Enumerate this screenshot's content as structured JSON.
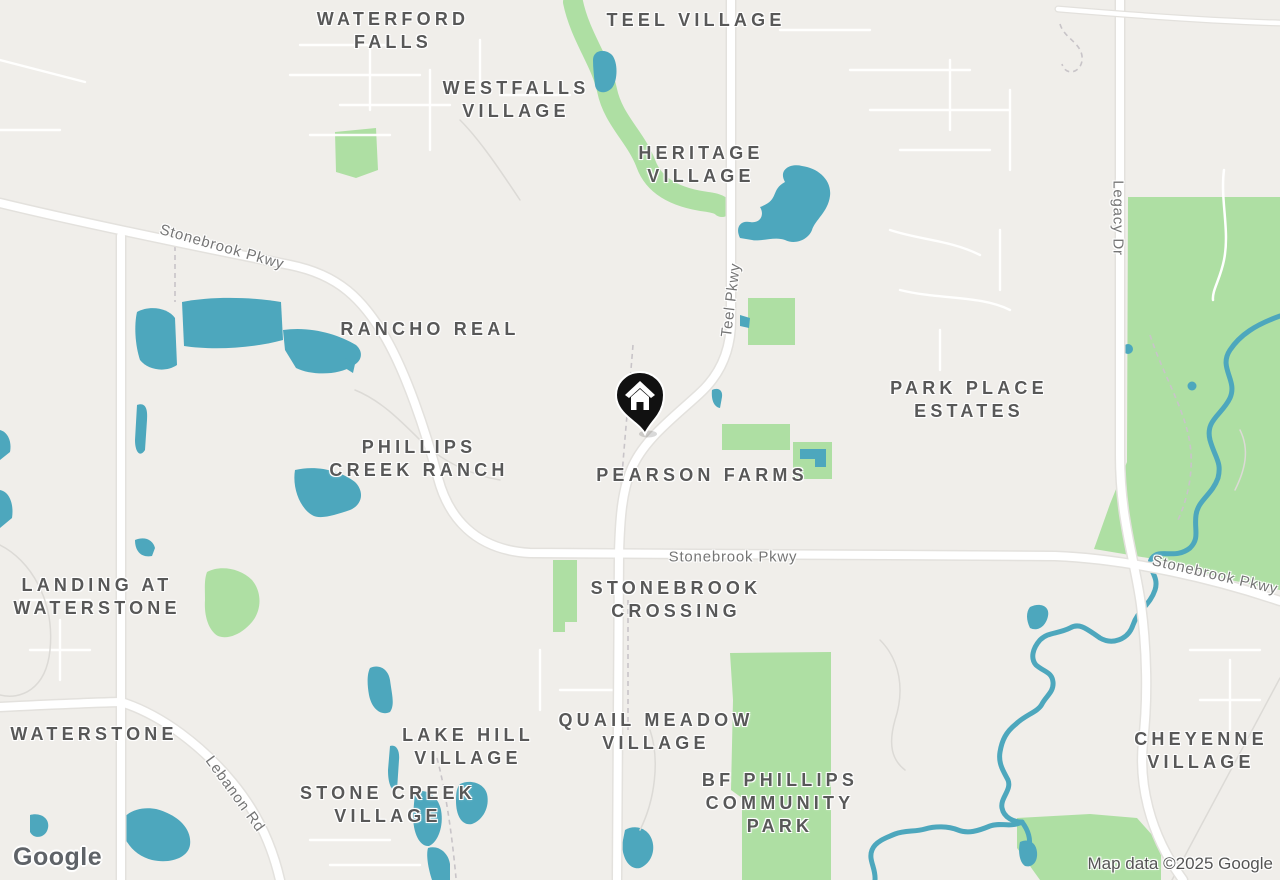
{
  "map": {
    "attribution": "Map data ©2025 Google",
    "logo": "Google",
    "marker": {
      "type": "home",
      "x": 640,
      "y": 400
    },
    "neighborhood_labels": [
      {
        "lines": [
          "WATERFORD",
          "FALLS"
        ],
        "x": 393,
        "y": 8
      },
      {
        "lines": [
          "TEEL VILLAGE"
        ],
        "x": 696,
        "y": 9
      },
      {
        "lines": [
          "WESTFALLS",
          "VILLAGE"
        ],
        "x": 516,
        "y": 77
      },
      {
        "lines": [
          "HERITAGE",
          "VILLAGE"
        ],
        "x": 701,
        "y": 142
      },
      {
        "lines": [
          "RANCHO REAL"
        ],
        "x": 430,
        "y": 318
      },
      {
        "lines": [
          "PARK PLACE",
          "ESTATES"
        ],
        "x": 969,
        "y": 377
      },
      {
        "lines": [
          "PHILLIPS",
          "CREEK RANCH"
        ],
        "x": 419,
        "y": 436
      },
      {
        "lines": [
          "PEARSON FARMS"
        ],
        "x": 702,
        "y": 464
      },
      {
        "lines": [
          "LANDING AT",
          "WATERSTONE"
        ],
        "x": 97,
        "y": 574
      },
      {
        "lines": [
          "STONEBROOK",
          "CROSSING"
        ],
        "x": 676,
        "y": 577
      },
      {
        "lines": [
          "WATERSTONE"
        ],
        "x": 94,
        "y": 723
      },
      {
        "lines": [
          "LAKE HILL",
          "VILLAGE"
        ],
        "x": 468,
        "y": 724
      },
      {
        "lines": [
          "QUAIL MEADOW",
          "VILLAGE"
        ],
        "x": 656,
        "y": 709
      },
      {
        "lines": [
          "STONE CREEK",
          "VILLAGE"
        ],
        "x": 388,
        "y": 782
      },
      {
        "lines": [
          "BF PHILLIPS",
          "COMMUNITY",
          "PARK"
        ],
        "x": 780,
        "y": 769
      },
      {
        "lines": [
          "CHEYENNE",
          "VILLAGE"
        ],
        "x": 1201,
        "y": 728
      }
    ],
    "road_labels": [
      {
        "text": "Stonebrook Pkwy",
        "x": 222,
        "y": 247,
        "rotation": 16
      },
      {
        "text": "Teel Pkwy",
        "x": 731,
        "y": 300,
        "rotation": -83
      },
      {
        "text": "Legacy Dr",
        "x": 1118,
        "y": 218,
        "rotation": 90
      },
      {
        "text": "Stonebrook Pkwy",
        "x": 733,
        "y": 557,
        "rotation": 0
      },
      {
        "text": "Stonebrook Pkwy",
        "x": 1215,
        "y": 575,
        "rotation": 13
      },
      {
        "text": "Lebanon Rd",
        "x": 235,
        "y": 794,
        "rotation": 54
      }
    ]
  },
  "colors": {
    "land": "#f0eeea",
    "water": "#4da7bd",
    "park": "#aedfa3",
    "road": "#ffffff",
    "road_casing": "#e3e1dd",
    "neighborhood_label": "#585858",
    "road_label": "#757575",
    "attribution": "#545454",
    "logo": "#5f6368",
    "marker": "#111111"
  }
}
